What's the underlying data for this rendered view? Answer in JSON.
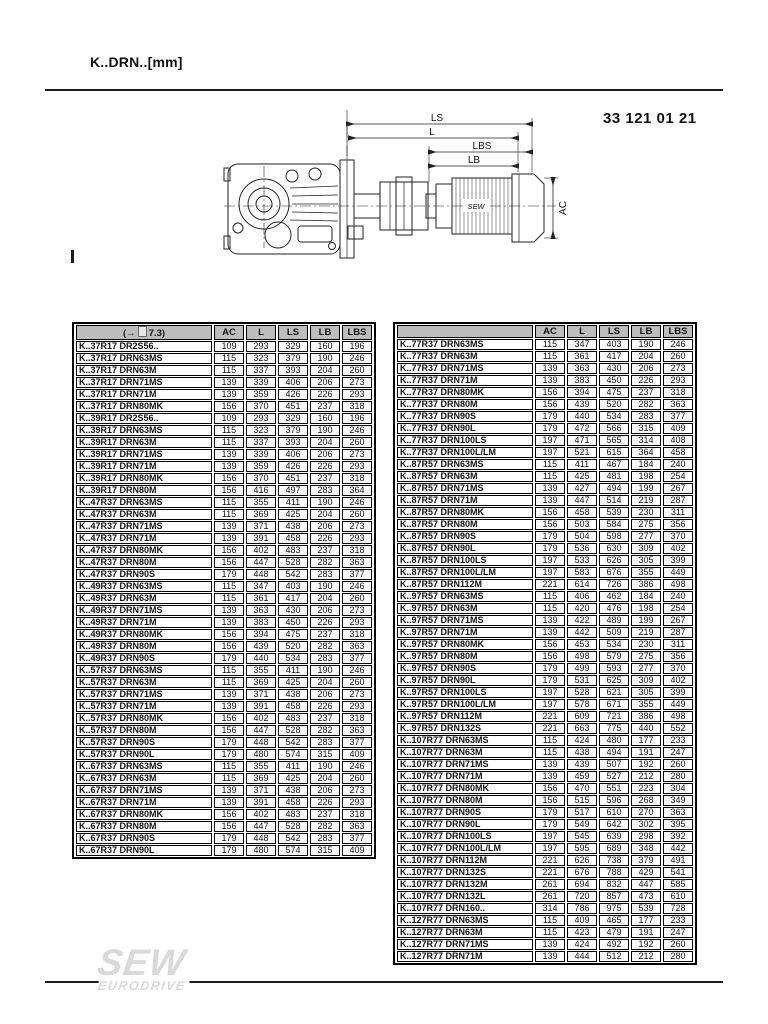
{
  "header": {
    "title": "K..DRN..[mm]",
    "doc_number": "33 121 01 21"
  },
  "drawing": {
    "dim_labels": {
      "ls": "LS",
      "l": "L",
      "lbs": "LBS",
      "lb": "LB",
      "ac": "AC"
    },
    "motor_label": "SEW"
  },
  "tables": {
    "columns": [
      "AC",
      "L",
      "LS",
      "LB",
      "LBS"
    ],
    "left": {
      "ref_prefix": "(→",
      "ref_suffix": "7.3)",
      "rows": [
        {
          "name": "K..37R17 DR2S56..",
          "values": [
            109,
            293,
            329,
            160,
            196
          ]
        },
        {
          "name": "K..37R17 DRN63MS",
          "values": [
            115,
            323,
            379,
            190,
            246
          ]
        },
        {
          "name": "K..37R17 DRN63M",
          "values": [
            115,
            337,
            393,
            204,
            260
          ]
        },
        {
          "name": "K..37R17 DRN71MS",
          "values": [
            139,
            339,
            406,
            206,
            273
          ]
        },
        {
          "name": "K..37R17 DRN71M",
          "values": [
            139,
            359,
            426,
            226,
            293
          ]
        },
        {
          "name": "K..37R17 DRN80MK",
          "values": [
            156,
            370,
            451,
            237,
            318
          ]
        },
        {
          "name": "K..39R17 DR2S56..",
          "values": [
            109,
            293,
            329,
            160,
            196
          ]
        },
        {
          "name": "K..39R17 DRN63MS",
          "values": [
            115,
            323,
            379,
            190,
            246
          ]
        },
        {
          "name": "K..39R17 DRN63M",
          "values": [
            115,
            337,
            393,
            204,
            260
          ]
        },
        {
          "name": "K..39R17 DRN71MS",
          "values": [
            139,
            339,
            406,
            206,
            273
          ]
        },
        {
          "name": "K..39R17 DRN71M",
          "values": [
            139,
            359,
            426,
            226,
            293
          ]
        },
        {
          "name": "K..39R17 DRN80MK",
          "values": [
            156,
            370,
            451,
            237,
            318
          ]
        },
        {
          "name": "K..39R17 DRN80M",
          "values": [
            156,
            416,
            497,
            283,
            364
          ]
        },
        {
          "name": "K..47R37 DRN63MS",
          "values": [
            115,
            355,
            411,
            190,
            246
          ]
        },
        {
          "name": "K..47R37 DRN63M",
          "values": [
            115,
            369,
            425,
            204,
            260
          ]
        },
        {
          "name": "K..47R37 DRN71MS",
          "values": [
            139,
            371,
            438,
            206,
            273
          ]
        },
        {
          "name": "K..47R37 DRN71M",
          "values": [
            139,
            391,
            458,
            226,
            293
          ]
        },
        {
          "name": "K..47R37 DRN80MK",
          "values": [
            156,
            402,
            483,
            237,
            318
          ]
        },
        {
          "name": "K..47R37 DRN80M",
          "values": [
            156,
            447,
            528,
            282,
            363
          ]
        },
        {
          "name": "K..47R37 DRN90S",
          "values": [
            179,
            448,
            542,
            283,
            377
          ]
        },
        {
          "name": "K..49R37 DRN63MS",
          "values": [
            115,
            347,
            403,
            190,
            246
          ]
        },
        {
          "name": "K..49R37 DRN63M",
          "values": [
            115,
            361,
            417,
            204,
            260
          ]
        },
        {
          "name": "K..49R37 DRN71MS",
          "values": [
            139,
            363,
            430,
            206,
            273
          ]
        },
        {
          "name": "K..49R37 DRN71M",
          "values": [
            139,
            383,
            450,
            226,
            293
          ]
        },
        {
          "name": "K..49R37 DRN80MK",
          "values": [
            156,
            394,
            475,
            237,
            318
          ]
        },
        {
          "name": "K..49R37 DRN80M",
          "values": [
            156,
            439,
            520,
            282,
            363
          ]
        },
        {
          "name": "K..49R37 DRN90S",
          "values": [
            179,
            440,
            534,
            283,
            377
          ]
        },
        {
          "name": "K..57R37 DRN63MS",
          "values": [
            115,
            355,
            411,
            190,
            246
          ]
        },
        {
          "name": "K..57R37 DRN63M",
          "values": [
            115,
            369,
            425,
            204,
            260
          ]
        },
        {
          "name": "K..57R37 DRN71MS",
          "values": [
            139,
            371,
            438,
            206,
            273
          ]
        },
        {
          "name": "K..57R37 DRN71M",
          "values": [
            139,
            391,
            458,
            226,
            293
          ]
        },
        {
          "name": "K..57R37 DRN80MK",
          "values": [
            156,
            402,
            483,
            237,
            318
          ]
        },
        {
          "name": "K..57R37 DRN80M",
          "values": [
            156,
            447,
            528,
            282,
            363
          ]
        },
        {
          "name": "K..57R37 DRN90S",
          "values": [
            179,
            448,
            542,
            283,
            377
          ]
        },
        {
          "name": "K..57R37 DRN90L",
          "values": [
            179,
            480,
            574,
            315,
            409
          ]
        },
        {
          "name": "K..67R37 DRN63MS",
          "values": [
            115,
            355,
            411,
            190,
            246
          ]
        },
        {
          "name": "K..67R37 DRN63M",
          "values": [
            115,
            369,
            425,
            204,
            260
          ]
        },
        {
          "name": "K..67R37 DRN71MS",
          "values": [
            139,
            371,
            438,
            206,
            273
          ]
        },
        {
          "name": "K..67R37 DRN71M",
          "values": [
            139,
            391,
            458,
            226,
            293
          ]
        },
        {
          "name": "K..67R37 DRN80MK",
          "values": [
            156,
            402,
            483,
            237,
            318
          ]
        },
        {
          "name": "K..67R37 DRN80M",
          "values": [
            156,
            447,
            528,
            282,
            363
          ]
        },
        {
          "name": "K..67R37 DRN90S",
          "values": [
            179,
            448,
            542,
            283,
            377
          ]
        },
        {
          "name": "K..67R37 DRN90L",
          "values": [
            179,
            480,
            574,
            315,
            409
          ]
        }
      ]
    },
    "right": {
      "rows": [
        {
          "name": "K..77R37 DRN63MS",
          "values": [
            115,
            347,
            403,
            190,
            246
          ]
        },
        {
          "name": "K..77R37 DRN63M",
          "values": [
            115,
            361,
            417,
            204,
            260
          ]
        },
        {
          "name": "K..77R37 DRN71MS",
          "values": [
            139,
            363,
            430,
            206,
            273
          ]
        },
        {
          "name": "K..77R37 DRN71M",
          "values": [
            139,
            383,
            450,
            226,
            293
          ]
        },
        {
          "name": "K..77R37 DRN80MK",
          "values": [
            156,
            394,
            475,
            237,
            318
          ]
        },
        {
          "name": "K..77R37 DRN80M",
          "values": [
            156,
            439,
            520,
            282,
            363
          ]
        },
        {
          "name": "K..77R37 DRN90S",
          "values": [
            179,
            440,
            534,
            283,
            377
          ]
        },
        {
          "name": "K..77R37 DRN90L",
          "values": [
            179,
            472,
            566,
            315,
            409
          ]
        },
        {
          "name": "K..77R37 DRN100LS",
          "values": [
            197,
            471,
            565,
            314,
            408
          ]
        },
        {
          "name": "K..77R37 DRN100L/LM",
          "values": [
            197,
            521,
            615,
            364,
            458
          ]
        },
        {
          "name": "K..87R57 DRN63MS",
          "values": [
            115,
            411,
            467,
            184,
            240
          ]
        },
        {
          "name": "K..87R57 DRN63M",
          "values": [
            115,
            425,
            481,
            198,
            254
          ]
        },
        {
          "name": "K..87R57 DRN71MS",
          "values": [
            139,
            427,
            494,
            199,
            267
          ]
        },
        {
          "name": "K..87R57 DRN71M",
          "values": [
            139,
            447,
            514,
            219,
            287
          ]
        },
        {
          "name": "K..87R57 DRN80MK",
          "values": [
            156,
            458,
            539,
            230,
            311
          ]
        },
        {
          "name": "K..87R57 DRN80M",
          "values": [
            156,
            503,
            584,
            275,
            356
          ]
        },
        {
          "name": "K..87R57 DRN90S",
          "values": [
            179,
            504,
            598,
            277,
            370
          ]
        },
        {
          "name": "K..87R57 DRN90L",
          "values": [
            179,
            536,
            630,
            309,
            402
          ]
        },
        {
          "name": "K..87R57 DRN100LS",
          "values": [
            197,
            533,
            626,
            305,
            399
          ]
        },
        {
          "name": "K..87R57 DRN100L/LM",
          "values": [
            197,
            583,
            676,
            355,
            449
          ]
        },
        {
          "name": "K..87R57 DRN112M",
          "values": [
            221,
            614,
            726,
            386,
            498
          ]
        },
        {
          "name": "K..97R57 DRN63MS",
          "values": [
            115,
            406,
            462,
            184,
            240
          ]
        },
        {
          "name": "K..97R57 DRN63M",
          "values": [
            115,
            420,
            476,
            198,
            254
          ]
        },
        {
          "name": "K..97R57 DRN71MS",
          "values": [
            139,
            422,
            489,
            199,
            267
          ]
        },
        {
          "name": "K..97R57 DRN71M",
          "values": [
            139,
            442,
            509,
            219,
            287
          ]
        },
        {
          "name": "K..97R57 DRN80MK",
          "values": [
            156,
            453,
            534,
            230,
            311
          ]
        },
        {
          "name": "K..97R57 DRN80M",
          "values": [
            156,
            498,
            579,
            275,
            356
          ]
        },
        {
          "name": "K..97R57 DRN90S",
          "values": [
            179,
            499,
            593,
            277,
            370
          ]
        },
        {
          "name": "K..97R57 DRN90L",
          "values": [
            179,
            531,
            625,
            309,
            402
          ]
        },
        {
          "name": "K..97R57 DRN100LS",
          "values": [
            197,
            528,
            621,
            305,
            399
          ]
        },
        {
          "name": "K..97R57 DRN100L/LM",
          "values": [
            197,
            578,
            671,
            355,
            449
          ]
        },
        {
          "name": "K..97R57 DRN112M",
          "values": [
            221,
            609,
            721,
            386,
            498
          ]
        },
        {
          "name": "K..97R57 DRN132S",
          "values": [
            221,
            663,
            775,
            440,
            552
          ]
        },
        {
          "name": "K..107R77 DRN63MS",
          "values": [
            115,
            424,
            480,
            177,
            233
          ]
        },
        {
          "name": "K..107R77 DRN63M",
          "values": [
            115,
            438,
            494,
            191,
            247
          ]
        },
        {
          "name": "K..107R77 DRN71MS",
          "values": [
            139,
            439,
            507,
            192,
            260
          ]
        },
        {
          "name": "K..107R77 DRN71M",
          "values": [
            139,
            459,
            527,
            212,
            280
          ]
        },
        {
          "name": "K..107R77 DRN80MK",
          "values": [
            156,
            470,
            551,
            223,
            304
          ]
        },
        {
          "name": "K..107R77 DRN80M",
          "values": [
            156,
            515,
            596,
            268,
            349
          ]
        },
        {
          "name": "K..107R77 DRN90S",
          "values": [
            179,
            517,
            610,
            270,
            363
          ]
        },
        {
          "name": "K..107R77 DRN90L",
          "values": [
            179,
            549,
            642,
            302,
            395
          ]
        },
        {
          "name": "K..107R77 DRN100LS",
          "values": [
            197,
            545,
            639,
            298,
            392
          ]
        },
        {
          "name": "K..107R77 DRN100L/LM",
          "values": [
            197,
            595,
            689,
            348,
            442
          ]
        },
        {
          "name": "K..107R77 DRN112M",
          "values": [
            221,
            626,
            738,
            379,
            491
          ]
        },
        {
          "name": "K..107R77 DRN132S",
          "values": [
            221,
            676,
            788,
            429,
            541
          ]
        },
        {
          "name": "K..107R77 DRN132M",
          "values": [
            261,
            694,
            832,
            447,
            585
          ]
        },
        {
          "name": "K..107R77 DRN132L",
          "values": [
            261,
            720,
            857,
            473,
            610
          ]
        },
        {
          "name": "K..107R77 DRN160..",
          "values": [
            314,
            786,
            975,
            539,
            728
          ]
        },
        {
          "name": "K..127R77 DRN63MS",
          "values": [
            115,
            409,
            465,
            177,
            233
          ]
        },
        {
          "name": "K..127R77 DRN63M",
          "values": [
            115,
            423,
            479,
            191,
            247
          ]
        },
        {
          "name": "K..127R77 DRN71MS",
          "values": [
            139,
            424,
            492,
            192,
            260
          ]
        },
        {
          "name": "K..127R77 DRN71M",
          "values": [
            139,
            444,
            512,
            212,
            280
          ]
        }
      ]
    }
  },
  "footer": {
    "logo_main": "SEW",
    "logo_sub": "EURODRIVE"
  }
}
